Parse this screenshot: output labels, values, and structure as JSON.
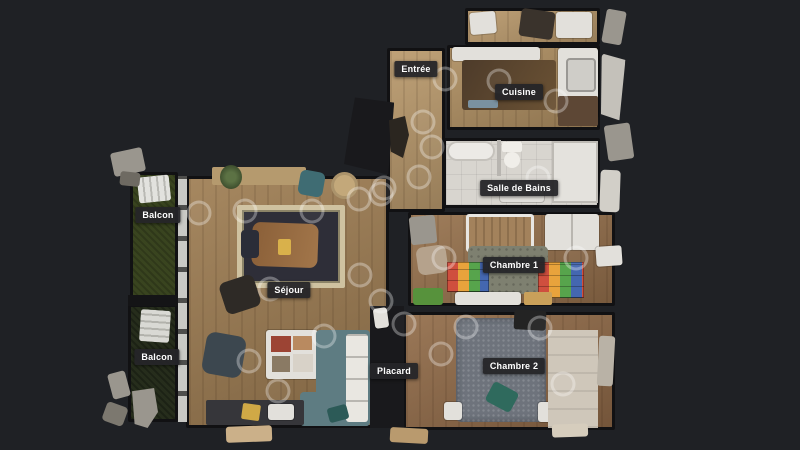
{
  "view": {
    "type": "dollhouse-floorplan-top-view",
    "background": "#1f2125"
  },
  "floorplan": {
    "rooms": [
      {
        "id": "entree",
        "label": "Entrée"
      },
      {
        "id": "cuisine",
        "label": "Cuisine"
      },
      {
        "id": "salle-de-bains",
        "label": "Salle de Bains"
      },
      {
        "id": "chambre-1",
        "label": "Chambre 1"
      },
      {
        "id": "chambre-2",
        "label": "Chambre 2"
      },
      {
        "id": "sejour",
        "label": "Séjour"
      },
      {
        "id": "placard",
        "label": "Placard"
      },
      {
        "id": "balcon-haut",
        "label": "Balcon"
      },
      {
        "id": "balcon-bas",
        "label": "Balcon"
      }
    ],
    "sweep_points": [
      [
        445,
        79
      ],
      [
        499,
        81
      ],
      [
        556,
        101
      ],
      [
        423,
        122
      ],
      [
        432,
        147
      ],
      [
        419,
        177
      ],
      [
        381,
        194
      ],
      [
        359,
        199
      ],
      [
        384,
        188
      ],
      [
        538,
        178
      ],
      [
        199,
        213
      ],
      [
        245,
        211
      ],
      [
        312,
        211
      ],
      [
        270,
        289
      ],
      [
        360,
        275
      ],
      [
        381,
        301
      ],
      [
        404,
        324
      ],
      [
        444,
        258
      ],
      [
        576,
        258
      ],
      [
        466,
        327
      ],
      [
        540,
        328
      ],
      [
        441,
        354
      ],
      [
        563,
        384
      ],
      [
        249,
        361
      ],
      [
        278,
        391
      ],
      [
        324,
        336
      ]
    ],
    "colors": {
      "background": "#1f2125",
      "wall": "#111113",
      "label_bg": "#252528",
      "label_text": "#ffffff",
      "sweep_ring": "rgba(255,255,255,0.30)",
      "wood_hall": "#b4956a",
      "wood_sejour": "#97774f",
      "wood_chambre": "#8a6545",
      "bathroom_tile": "#d8d5cf",
      "balcony_grass": "#39441f",
      "bed": "#6e737c",
      "bed_cushion": "#2f6a5d",
      "sofa": "#5e7c82"
    }
  }
}
